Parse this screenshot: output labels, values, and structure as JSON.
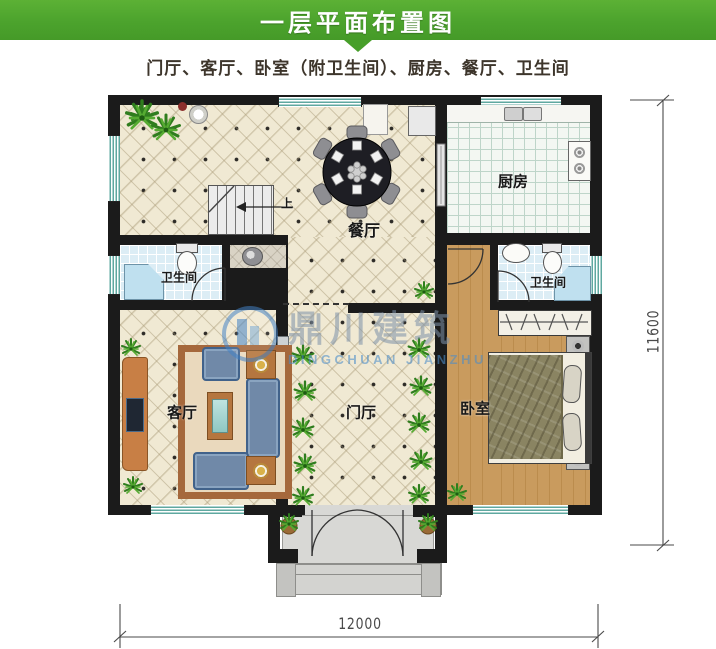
{
  "header": {
    "title": "一层平面布置图",
    "bg_color": "#4ca32d"
  },
  "subtitle": "门厅、客厅、卧室（附卫生间）、厨房、餐厅、卫生间",
  "watermark": {
    "cn": "鼎川建筑",
    "en": "DINGCHUAN JIANZHU"
  },
  "rooms": {
    "kitchen": "厨房",
    "dining": "餐厅",
    "bathroom_left": "卫生间",
    "bathroom_right": "卫生间",
    "living": "客厅",
    "foyer": "门厅",
    "bedroom": "卧室",
    "stairs_up": "上"
  },
  "dimensions": {
    "bottom": "12000",
    "right": "11600"
  },
  "colors": {
    "wall": "#1b1b1b",
    "tile_floor": "#f0e9d3",
    "wood_floor": "#c99b5e",
    "window": "#5fa8a0",
    "accent_green": "#4ca32d"
  }
}
